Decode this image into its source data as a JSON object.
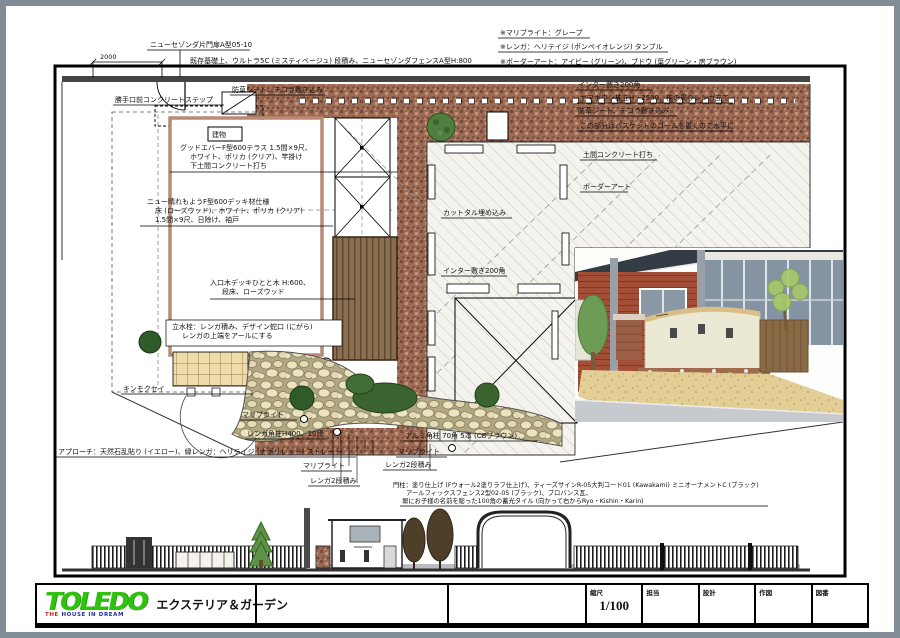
{
  "colors": {
    "page_border": "#828c96",
    "brick": "#9c6b55",
    "stone": "#ece3bf",
    "deck_brown": "#8a6f4e",
    "siding_red": "#a34f38",
    "roof_dark": "#333b44",
    "gravel": "#e3cf96",
    "logo_green": "#2fc30f",
    "tagline_red": "#c9271e",
    "tagline_blue": "#1f2f9e"
  },
  "dim": {
    "top_left": "2000"
  },
  "ann": {
    "gate": "ニューセゾンダ片門扉A型05-10",
    "fence_top": "既存基礎上、ウルトラ5C (ミスティベージュ) 段積み、ニューセゾンダフェンスA型H:800",
    "weed_top": "防草シート、テコラ敷き込み",
    "step": "勝手口前コンクリートステップ",
    "note_marib": "※マリブライト：グレープ",
    "note_brick": "※レンガ：ヘリテイジ (ポンペイオレンジ) タンブル",
    "note_border": "※ボーダーアート：アイビー (グリーン)、ブドウ (葉グリーン・房ブラウン)",
    "inter": "インター敷き200角",
    "yamaboushi": "ヤマボウシ株立H：2500、株の周りレンガ立て",
    "weed_right": "防草シート、テコラ敷き込み",
    "basket": "この部分はバスケットのゴールを置くので水平に",
    "doma": "土間コンクリート打ち",
    "border_art": "ボーダーアート",
    "building": "建物",
    "terrace1": "グッドエバーF型600テラス 1.5間×9尺、",
    "terrace2": "ホワイト、ポリカ (クリア)、竿掛け",
    "terrace3": "下土間コンクリート打ち",
    "deck1": "ニュー晴れもようF型600デッキ材仕様",
    "deck2": "床 (ローズウッド)、ホワイト、ポリカ (クリア)",
    "deck3": "1.5間×9尺、日除け、袖戸",
    "entry1": "入口木デッキひとと木 H:600、",
    "entry2": "段床、ローズウッド",
    "tap1": "立水栓：レンガ積み、デザイン蛇口 (にがら)",
    "tap2": "レンガの上端をアールにする",
    "kinmokusei": "キンモクセイ",
    "cuttal": "カットタル埋め込み",
    "marib": "マリブライト",
    "brick_post": "レンガ角柱H400、10段",
    "approach": "アプローチ：天然石乱貼り (イエロー)、縁レンガ：ヘリテイジ (ナポリレッド) ストレート",
    "brick2": "レンガ2段積み",
    "alum": "アルミ角柱 70角 5本 (CBブラウン)",
    "gb1": "門柱：塗り仕上げ (Fウォール2塗りラフ仕上げ)、ティーズサインR-05大判コード01 (Kawakami) ミニオーナメントC (ブラック)",
    "gb2": "アールフィックスフェンス2型02-05 (ブラック)、プロバンス瓦、",
    "gb3": "塀にお子様の名前を彫った100角の蓄光タイル (向かって右からRyo・Kishin・Karin)"
  },
  "title_block": {
    "logo": "TOLEDO",
    "tagline_word1": "THE",
    "tagline_rest": "HOUSE IN DREAM",
    "subtitle": "エクステリア＆ガーデン",
    "fields": [
      {
        "label": "縮尺",
        "value": "1/100"
      },
      {
        "label": "担当",
        "value": ""
      },
      {
        "label": "設計",
        "value": ""
      },
      {
        "label": "作図",
        "value": ""
      },
      {
        "label": "図番",
        "value": ""
      }
    ]
  }
}
